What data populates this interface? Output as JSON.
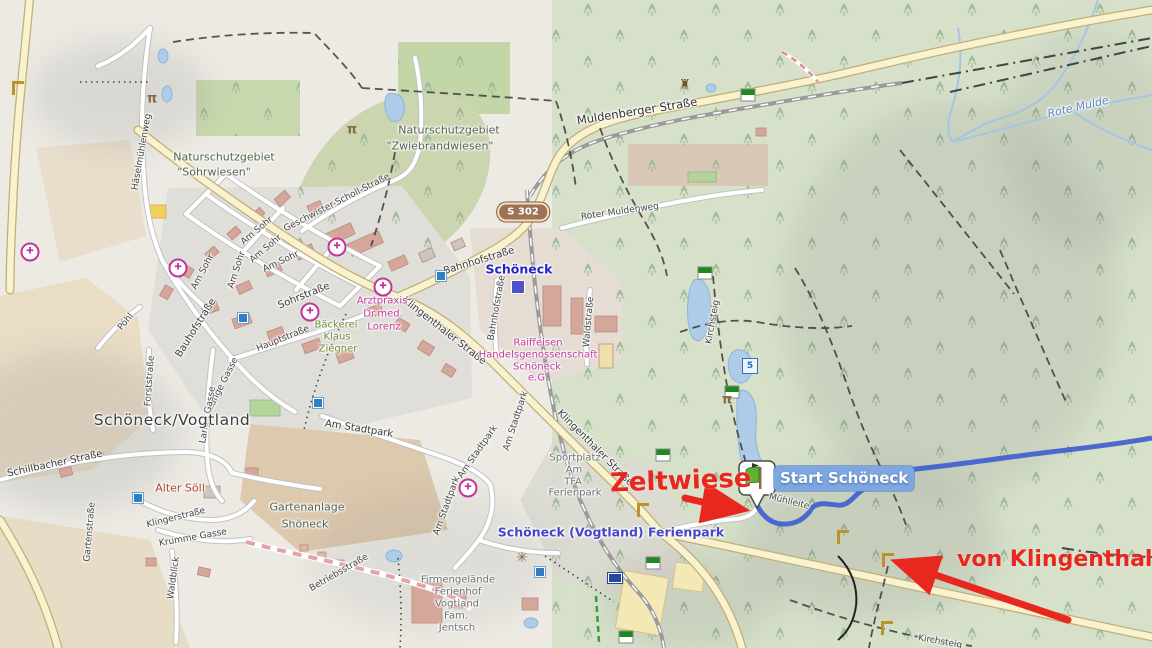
{
  "annotations": {
    "zeltwiese": "Zeltwiese",
    "von_klingenthal": "von Klingenthal"
  },
  "start_marker": {
    "label": "Start Schöneck"
  },
  "road_shield": {
    "text": "S 302"
  },
  "colors": {
    "annotation_red": "#e8281e",
    "route_blue": "#3d5ccf",
    "major_road": "#f8f2cf",
    "forest": "#d7e1ca",
    "water": "#aecbe8",
    "start_label_bg": "#7ea6e0",
    "poi_pink": "#c03a9c",
    "shield_brown": "#9c7356"
  },
  "labels": [
    {
      "text": "Häselmühlenweg",
      "x": 142,
      "y": 152,
      "rot": -80,
      "cls": "street-sm"
    },
    {
      "text": "Muldenberger Straße",
      "x": 637,
      "y": 111,
      "rot": -9,
      "cls": "street-lg"
    },
    {
      "text": "Roter Muldenweg",
      "x": 620,
      "y": 212,
      "rot": -8,
      "cls": "street-sm"
    },
    {
      "text": "Geschwister-Scholl-Straße",
      "x": 337,
      "y": 203,
      "rot": -27,
      "cls": "street-sm"
    },
    {
      "text": "Am Sohr",
      "x": 257,
      "y": 231,
      "rot": -40,
      "cls": "street-sm"
    },
    {
      "text": "Am Sohr",
      "x": 266,
      "y": 249,
      "rot": -40,
      "cls": "street-sm"
    },
    {
      "text": "Am Sohr",
      "x": 281,
      "y": 262,
      "rot": -25,
      "cls": "street-sm"
    },
    {
      "text": "Am Sohr",
      "x": 203,
      "y": 272,
      "rot": -62,
      "cls": "street-sm"
    },
    {
      "text": "Am Sohr",
      "x": 237,
      "y": 270,
      "rot": -72,
      "cls": "street-sm"
    },
    {
      "text": "Sohrstraße",
      "x": 304,
      "y": 296,
      "rot": -22,
      "cls": "street"
    },
    {
      "text": "Bauhofstraße",
      "x": 196,
      "y": 328,
      "rot": -58,
      "cls": "street"
    },
    {
      "text": "Hauptstraße",
      "x": 283,
      "y": 339,
      "rot": -22,
      "cls": "street-sm"
    },
    {
      "text": "Bahnhofstraße",
      "x": 479,
      "y": 261,
      "rot": -17,
      "cls": "street"
    },
    {
      "text": "Bahnhofstraße",
      "x": 497,
      "y": 308,
      "rot": -80,
      "cls": "street-sm"
    },
    {
      "text": "Klingenthaler Straße",
      "x": 444,
      "y": 331,
      "rot": 38,
      "cls": "street"
    },
    {
      "text": "Klingenthaler Straße",
      "x": 595,
      "y": 448,
      "rot": 45,
      "cls": "street"
    },
    {
      "text": "Waldstraße",
      "x": 589,
      "y": 322,
      "rot": -85,
      "cls": "street-sm"
    },
    {
      "text": "Schillbacher Straße",
      "x": 55,
      "y": 464,
      "rot": -12,
      "cls": "street"
    },
    {
      "text": "Pöhl",
      "x": 126,
      "y": 322,
      "rot": -50,
      "cls": "street-sm"
    },
    {
      "text": "Forststraße",
      "x": 150,
      "y": 381,
      "rot": -86,
      "cls": "street-sm"
    },
    {
      "text": "Lange Gasse",
      "x": 223,
      "y": 384,
      "rot": -63,
      "cls": "street-sm"
    },
    {
      "text": "Lange Gasse",
      "x": 208,
      "y": 415,
      "rot": -80,
      "cls": "street-sm"
    },
    {
      "text": "Gartenstraße",
      "x": 90,
      "y": 532,
      "rot": -85,
      "cls": "street-sm"
    },
    {
      "text": "Klingerstraße",
      "x": 176,
      "y": 518,
      "rot": -14,
      "cls": "street-sm"
    },
    {
      "text": "Krumme Gasse",
      "x": 193,
      "y": 538,
      "rot": -10,
      "cls": "street-sm"
    },
    {
      "text": "Waldblick",
      "x": 174,
      "y": 578,
      "rot": -82,
      "cls": "street-sm"
    },
    {
      "text": "Am Stadtpark",
      "x": 359,
      "y": 429,
      "rot": 9,
      "cls": "street"
    },
    {
      "text": "Am Stadtpark",
      "x": 478,
      "y": 452,
      "rot": -55,
      "cls": "street-sm"
    },
    {
      "text": "Am Stadtpark",
      "x": 516,
      "y": 421,
      "rot": -72,
      "cls": "street-sm"
    },
    {
      "text": "Am Stadtpark",
      "x": 447,
      "y": 506,
      "rot": -70,
      "cls": "street-sm"
    },
    {
      "text": "Betriebsstraße",
      "x": 339,
      "y": 573,
      "rot": -30,
      "cls": "street-sm"
    },
    {
      "text": "Kirchsteig",
      "x": 713,
      "y": 322,
      "rot": -80,
      "cls": "street-sm"
    },
    {
      "text": "Kirchsteig",
      "x": 940,
      "y": 642,
      "rot": 10,
      "cls": "street-sm"
    },
    {
      "text": "Mühlleite",
      "x": 789,
      "y": 502,
      "rot": 14,
      "cls": "street-sm"
    },
    {
      "text": "Naturschutzgebiet",
      "x": 224,
      "y": 157,
      "rot": 0,
      "cls": "area"
    },
    {
      "text": "\"Sohrwiesen\"",
      "x": 214,
      "y": 172,
      "rot": 0,
      "cls": "area"
    },
    {
      "text": "Naturschutzgebiet",
      "x": 449,
      "y": 130,
      "rot": 0,
      "cls": "area"
    },
    {
      "text": "\"Zwiebrandwiesen\"",
      "x": 440,
      "y": 146,
      "rot": 0,
      "cls": "area"
    },
    {
      "text": "Gartenanlage",
      "x": 307,
      "y": 507,
      "rot": 0,
      "cls": "area"
    },
    {
      "text": "Shöneck",
      "x": 305,
      "y": 524,
      "rot": 0,
      "cls": "area"
    },
    {
      "text": "Sportplatz",
      "x": 575,
      "y": 458,
      "rot": 0,
      "cls": "area-gray"
    },
    {
      "text": "Am",
      "x": 574,
      "y": 470,
      "rot": 0,
      "cls": "area-gray"
    },
    {
      "text": "TFA",
      "x": 573,
      "y": 482,
      "rot": 0,
      "cls": "area-gray"
    },
    {
      "text": "Ferienpark",
      "x": 575,
      "y": 493,
      "rot": 0,
      "cls": "area-gray"
    },
    {
      "text": "Firmengelände",
      "x": 458,
      "y": 580,
      "rot": 0,
      "cls": "area-gray"
    },
    {
      "text": "Ferienhof",
      "x": 458,
      "y": 592,
      "rot": 0,
      "cls": "area-gray"
    },
    {
      "text": "Vogtland",
      "x": 457,
      "y": 604,
      "rot": 0,
      "cls": "area-gray"
    },
    {
      "text": "Fam.",
      "x": 456,
      "y": 616,
      "rot": 0,
      "cls": "area-gray"
    },
    {
      "text": "Jentsch",
      "x": 457,
      "y": 628,
      "rot": 0,
      "cls": "area-gray"
    },
    {
      "text": "Arztpraxis",
      "x": 382,
      "y": 301,
      "rot": 0,
      "cls": "poi-pink"
    },
    {
      "text": "Dr.med.",
      "x": 383,
      "y": 314,
      "rot": 0,
      "cls": "poi-pink"
    },
    {
      "text": "Lorenz",
      "x": 384,
      "y": 327,
      "rot": 0,
      "cls": "poi-pink"
    },
    {
      "text": "Raiffeisen",
      "x": 538,
      "y": 343,
      "rot": 0,
      "cls": "poi-pink"
    },
    {
      "text": "Handelsgenossenschaft",
      "x": 538,
      "y": 355,
      "rot": 0,
      "cls": "poi-pink"
    },
    {
      "text": "Schöneck",
      "x": 537,
      "y": 367,
      "rot": 0,
      "cls": "poi-pink"
    },
    {
      "text": "e.G.",
      "x": 538,
      "y": 378,
      "rot": 0,
      "cls": "poi-pink"
    },
    {
      "text": "Bäckerei",
      "x": 336,
      "y": 325,
      "rot": 0,
      "cls": "poi-green"
    },
    {
      "text": "Klaus",
      "x": 337,
      "y": 337,
      "rot": 0,
      "cls": "poi-green"
    },
    {
      "text": "Ziegner",
      "x": 338,
      "y": 349,
      "rot": 0,
      "cls": "poi-green"
    },
    {
      "text": "Alter Söll",
      "x": 180,
      "y": 488,
      "rot": 0,
      "cls": "poi-red"
    },
    {
      "text": "Rote Mulde",
      "x": 1078,
      "y": 107,
      "rot": -13,
      "cls": "water-label"
    },
    {
      "text": "Schöneck/Vogtland",
      "x": 172,
      "y": 420,
      "rot": 0,
      "cls": "place"
    },
    {
      "text": "Schöneck",
      "x": 519,
      "y": 269,
      "rot": 0,
      "cls": "station"
    },
    {
      "text": "Schöneck (Vogtland) Ferienpark",
      "x": 611,
      "y": 532,
      "rot": 0,
      "cls": "tourism"
    }
  ],
  "icons": [
    {
      "type": "pharmacy",
      "x": 30,
      "y": 252
    },
    {
      "type": "pharmacy",
      "x": 178,
      "y": 268
    },
    {
      "type": "pharmacy",
      "x": 337,
      "y": 247
    },
    {
      "type": "pharmacy",
      "x": 383,
      "y": 287
    },
    {
      "type": "pharmacy",
      "x": 310,
      "y": 312
    },
    {
      "type": "pharmacy",
      "x": 468,
      "y": 488
    },
    {
      "type": "bus",
      "x": 243,
      "y": 318
    },
    {
      "type": "bus",
      "x": 318,
      "y": 403
    },
    {
      "type": "bus",
      "x": 441,
      "y": 276
    },
    {
      "type": "bus",
      "x": 138,
      "y": 498
    },
    {
      "type": "bus",
      "x": 540,
      "y": 572
    },
    {
      "type": "station",
      "x": 518,
      "y": 287
    },
    {
      "type": "blaze",
      "x": 748,
      "y": 95
    },
    {
      "type": "blaze",
      "x": 705,
      "y": 273
    },
    {
      "type": "blaze",
      "x": 732,
      "y": 392
    },
    {
      "type": "blaze",
      "x": 663,
      "y": 455
    },
    {
      "type": "blaze",
      "x": 653,
      "y": 563
    },
    {
      "type": "blaze",
      "x": 626,
      "y": 637
    },
    {
      "type": "gate",
      "x": 18,
      "y": 88
    },
    {
      "type": "gate",
      "x": 888,
      "y": 560
    },
    {
      "type": "gate",
      "x": 643,
      "y": 510
    },
    {
      "type": "gate",
      "x": 843,
      "y": 537
    },
    {
      "type": "gate",
      "x": 887,
      "y": 628
    },
    {
      "type": "picnic",
      "x": 727,
      "y": 400
    },
    {
      "type": "picnic",
      "x": 152,
      "y": 99
    },
    {
      "type": "picnic",
      "x": 352,
      "y": 130
    },
    {
      "type": "tower",
      "x": 685,
      "y": 85
    },
    {
      "type": "windmill",
      "x": 522,
      "y": 558
    },
    {
      "type": "board",
      "x": 615,
      "y": 578
    },
    {
      "type": "node",
      "x": 750,
      "y": 366,
      "text": "5"
    }
  ]
}
